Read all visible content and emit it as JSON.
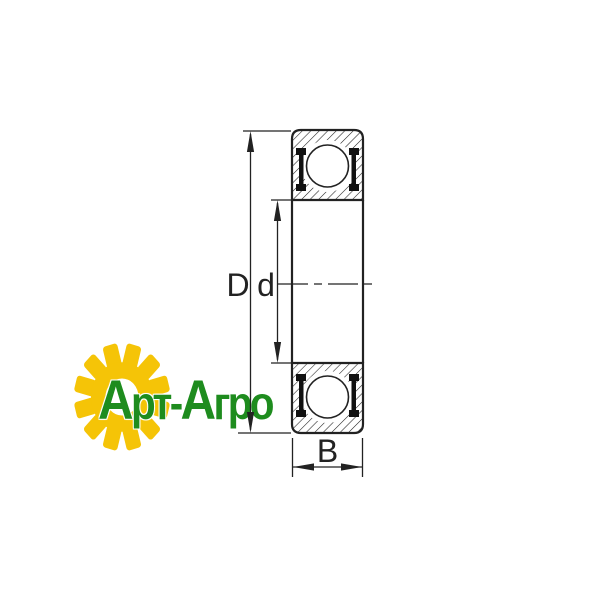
{
  "watermark": {
    "brand_part1": "Арт-",
    "brand_part2": "Агро",
    "gear_color": "#F5C407",
    "text_color": "#1E8C1E"
  },
  "diagram": {
    "type": "bearing cross-section drawing",
    "labels": {
      "outer_diameter": "D",
      "bore_diameter": "d",
      "width": "B"
    },
    "line_color": "#222222",
    "background_color": "#FFFFFF"
  }
}
